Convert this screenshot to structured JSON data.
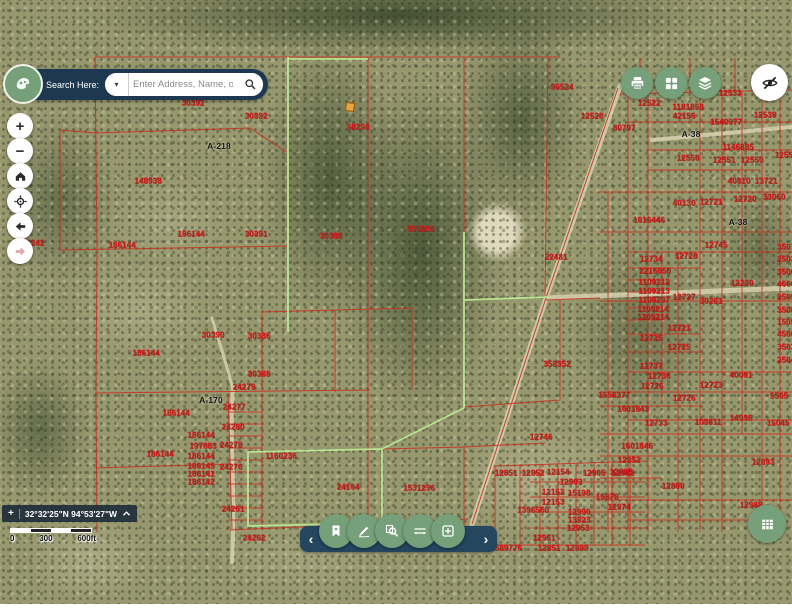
{
  "search": {
    "label": "Search Here:",
    "placeholder": "Enter Address, Name, or ID",
    "caret": "▾"
  },
  "colors": {
    "navy": "#1d3850",
    "button_green": "#76a07a",
    "parcel_red": "#c8321f",
    "parcel_green": "#bce892"
  },
  "left_controls": {
    "zoom_in": "+",
    "zoom_out": "−"
  },
  "toolbar": {
    "chevron_left": "‹",
    "chevron_right": "›"
  },
  "status": {
    "crosshair": "+",
    "coordinates": "32°32'25\"N 94°53'27\"W"
  },
  "scale_bar": {
    "ticks": [
      "0",
      "300",
      "600ft"
    ]
  },
  "map": {
    "marker": {
      "x": 350,
      "y": 107
    },
    "labels": [
      {
        "t": "30392",
        "x": 193,
        "y": 103
      },
      {
        "t": "30392",
        "x": 256,
        "y": 116
      },
      {
        "t": "A-218",
        "x": 219,
        "y": 146,
        "k": 1
      },
      {
        "t": "98298",
        "x": 358,
        "y": 127
      },
      {
        "t": "148938",
        "x": 148,
        "y": 181
      },
      {
        "t": "186144",
        "x": 122,
        "y": 245
      },
      {
        "t": "186144",
        "x": 191,
        "y": 234
      },
      {
        "t": "30391",
        "x": 256,
        "y": 234
      },
      {
        "t": "30388",
        "x": 331,
        "y": 236
      },
      {
        "t": "598268",
        "x": 421,
        "y": 229
      },
      {
        "t": "22481",
        "x": 556,
        "y": 257
      },
      {
        "t": "99524",
        "x": 562,
        "y": 87
      },
      {
        "t": "12528",
        "x": 592,
        "y": 116
      },
      {
        "t": "12522",
        "x": 649,
        "y": 103
      },
      {
        "t": "1181858",
        "x": 688,
        "y": 107
      },
      {
        "t": "42156",
        "x": 684,
        "y": 116
      },
      {
        "t": "1540977",
        "x": 726,
        "y": 122
      },
      {
        "t": "12533",
        "x": 730,
        "y": 93
      },
      {
        "t": "12539",
        "x": 765,
        "y": 115
      },
      {
        "t": "80797",
        "x": 624,
        "y": 128
      },
      {
        "t": "A-38",
        "x": 691,
        "y": 134,
        "k": 1
      },
      {
        "t": "1146885",
        "x": 738,
        "y": 147
      },
      {
        "t": "12550",
        "x": 688,
        "y": 158
      },
      {
        "t": "12551",
        "x": 724,
        "y": 160
      },
      {
        "t": "12550",
        "x": 752,
        "y": 160
      },
      {
        "t": "12555",
        "x": 786,
        "y": 155
      },
      {
        "t": "40810",
        "x": 739,
        "y": 181
      },
      {
        "t": "13721",
        "x": 766,
        "y": 181
      },
      {
        "t": "40130",
        "x": 684,
        "y": 203
      },
      {
        "t": "12721",
        "x": 711,
        "y": 202
      },
      {
        "t": "12720",
        "x": 745,
        "y": 199
      },
      {
        "t": "33060",
        "x": 774,
        "y": 197
      },
      {
        "t": "1016446",
        "x": 649,
        "y": 220
      },
      {
        "t": "A-38",
        "x": 738,
        "y": 222,
        "k": 1
      },
      {
        "t": "12745",
        "x": 716,
        "y": 245
      },
      {
        "t": "12734",
        "x": 651,
        "y": 259
      },
      {
        "t": "12728",
        "x": 686,
        "y": 256
      },
      {
        "t": "2216650",
        "x": 655,
        "y": 271
      },
      {
        "t": "1109212",
        "x": 654,
        "y": 282
      },
      {
        "t": "1109213",
        "x": 654,
        "y": 291
      },
      {
        "t": "1109207",
        "x": 654,
        "y": 300
      },
      {
        "t": "12727",
        "x": 684,
        "y": 297
      },
      {
        "t": "1109214",
        "x": 653,
        "y": 309
      },
      {
        "t": "1209214",
        "x": 653,
        "y": 317
      },
      {
        "t": "30281",
        "x": 711,
        "y": 301
      },
      {
        "t": "12230",
        "x": 742,
        "y": 283
      },
      {
        "t": "12721",
        "x": 679,
        "y": 328
      },
      {
        "t": "12735",
        "x": 651,
        "y": 338
      },
      {
        "t": "12725",
        "x": 679,
        "y": 347
      },
      {
        "t": "12737",
        "x": 651,
        "y": 366
      },
      {
        "t": "12736",
        "x": 659,
        "y": 376
      },
      {
        "t": "12726",
        "x": 652,
        "y": 386
      },
      {
        "t": "1558377",
        "x": 614,
        "y": 395
      },
      {
        "t": "12726",
        "x": 684,
        "y": 398
      },
      {
        "t": "40001",
        "x": 741,
        "y": 375
      },
      {
        "t": "12723",
        "x": 711,
        "y": 385
      },
      {
        "t": "1601843",
        "x": 633,
        "y": 409
      },
      {
        "t": "12733",
        "x": 656,
        "y": 423
      },
      {
        "t": "109811",
        "x": 708,
        "y": 422
      },
      {
        "t": "14936",
        "x": 741,
        "y": 418
      },
      {
        "t": "1601846",
        "x": 637,
        "y": 446
      },
      {
        "t": "12893",
        "x": 763,
        "y": 462
      },
      {
        "t": "12852",
        "x": 629,
        "y": 460
      },
      {
        "t": "12985",
        "x": 621,
        "y": 472
      },
      {
        "t": "12890",
        "x": 673,
        "y": 486
      },
      {
        "t": "19878",
        "x": 607,
        "y": 497
      },
      {
        "t": "12974",
        "x": 619,
        "y": 507
      },
      {
        "t": "12988",
        "x": 751,
        "y": 505
      },
      {
        "t": "15045",
        "x": 778,
        "y": 423
      },
      {
        "t": "9505",
        "x": 779,
        "y": 396
      },
      {
        "t": "358352",
        "x": 557,
        "y": 364
      },
      {
        "t": "12746",
        "x": 541,
        "y": 437
      },
      {
        "t": "12851",
        "x": 506,
        "y": 473
      },
      {
        "t": "12852",
        "x": 533,
        "y": 473
      },
      {
        "t": "12154",
        "x": 558,
        "y": 472
      },
      {
        "t": "12905",
        "x": 594,
        "y": 473
      },
      {
        "t": "12982",
        "x": 623,
        "y": 473
      },
      {
        "t": "12903",
        "x": 571,
        "y": 482
      },
      {
        "t": "12152",
        "x": 553,
        "y": 492
      },
      {
        "t": "15198",
        "x": 579,
        "y": 493
      },
      {
        "t": "12153",
        "x": 553,
        "y": 502
      },
      {
        "t": "1396560",
        "x": 533,
        "y": 510
      },
      {
        "t": "12990",
        "x": 579,
        "y": 512
      },
      {
        "t": "13923",
        "x": 579,
        "y": 520
      },
      {
        "t": "12953",
        "x": 578,
        "y": 528
      },
      {
        "t": "12951",
        "x": 544,
        "y": 538
      },
      {
        "t": "12851",
        "x": 549,
        "y": 548
      },
      {
        "t": "12899",
        "x": 577,
        "y": 548
      },
      {
        "t": "1589776",
        "x": 506,
        "y": 548
      },
      {
        "t": "30390",
        "x": 213,
        "y": 335
      },
      {
        "t": "30386",
        "x": 259,
        "y": 336
      },
      {
        "t": "30388",
        "x": 259,
        "y": 374
      },
      {
        "t": "24279",
        "x": 244,
        "y": 387
      },
      {
        "t": "A-170",
        "x": 211,
        "y": 400,
        "k": 1
      },
      {
        "t": "186144",
        "x": 146,
        "y": 353
      },
      {
        "t": "186144",
        "x": 176,
        "y": 413
      },
      {
        "t": "24277",
        "x": 234,
        "y": 407
      },
      {
        "t": "24280",
        "x": 233,
        "y": 427
      },
      {
        "t": "186144",
        "x": 201,
        "y": 435
      },
      {
        "t": "197683",
        "x": 203,
        "y": 446
      },
      {
        "t": "24278",
        "x": 231,
        "y": 445
      },
      {
        "t": "186144",
        "x": 201,
        "y": 456
      },
      {
        "t": "186145",
        "x": 201,
        "y": 466
      },
      {
        "t": "24276",
        "x": 231,
        "y": 467
      },
      {
        "t": "186141",
        "x": 201,
        "y": 474
      },
      {
        "t": "186142",
        "x": 201,
        "y": 482
      },
      {
        "t": "186144",
        "x": 160,
        "y": 454
      },
      {
        "t": "24261",
        "x": 233,
        "y": 509
      },
      {
        "t": "24262",
        "x": 254,
        "y": 538
      },
      {
        "t": "1160236",
        "x": 281,
        "y": 456
      },
      {
        "t": "24164",
        "x": 348,
        "y": 487
      },
      {
        "t": "1531296",
        "x": 419,
        "y": 488
      },
      {
        "t": "12242",
        "x": 33,
        "y": 243
      },
      {
        "t": "3507",
        "x": 786,
        "y": 247
      },
      {
        "t": "2503",
        "x": 786,
        "y": 259
      },
      {
        "t": "3506",
        "x": 786,
        "y": 272
      },
      {
        "t": "4606",
        "x": 786,
        "y": 284
      },
      {
        "t": "2505",
        "x": 786,
        "y": 297
      },
      {
        "t": "3508",
        "x": 786,
        "y": 310
      },
      {
        "t": "1505",
        "x": 786,
        "y": 322
      },
      {
        "t": "4506",
        "x": 786,
        "y": 334
      },
      {
        "t": "3503",
        "x": 786,
        "y": 347
      },
      {
        "t": "2504",
        "x": 786,
        "y": 360
      }
    ]
  }
}
